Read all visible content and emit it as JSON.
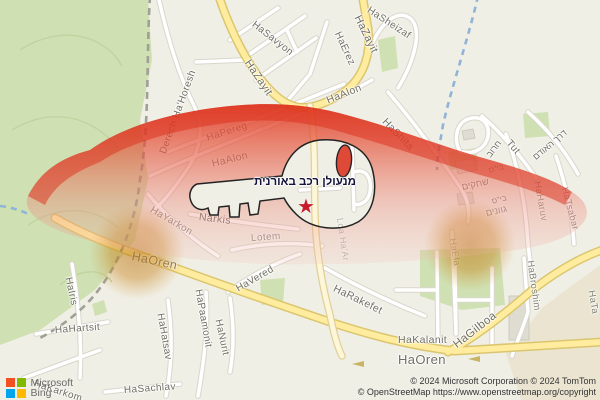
{
  "map": {
    "business": {
      "label": "מנעולן רכב באורנית",
      "marker_icon": "star-icon"
    },
    "street_labels": [
      {
        "id": "hasavyon",
        "text": "HaSavyon",
        "x": 253,
        "y": 18,
        "rot": 38,
        "size": 10
      },
      {
        "id": "hazayit-1",
        "text": "HaZayit",
        "x": 247,
        "y": 55,
        "rot": 56,
        "size": 11
      },
      {
        "id": "hazayit-2",
        "text": "HaZayit",
        "x": 357,
        "y": 10,
        "rot": 64,
        "size": 11
      },
      {
        "id": "hasheizaf",
        "text": "HaSheizaf",
        "x": 368,
        "y": 4,
        "rot": 33,
        "size": 10
      },
      {
        "id": "derech-hahoresh",
        "text": "Derech Ha'Horesh",
        "x": 163,
        "y": 148,
        "rot": -70,
        "size": 10
      },
      {
        "id": "haerez",
        "text": "HaErez",
        "x": 337,
        "y": 27,
        "rot": 65,
        "size": 10
      },
      {
        "id": "haalon-1",
        "text": "HaAlon",
        "x": 327,
        "y": 95,
        "rot": -22,
        "size": 10.5
      },
      {
        "id": "haalon-2",
        "text": "HaAlon",
        "x": 212,
        "y": 158,
        "rot": -14,
        "size": 10.5,
        "opacity": 0.85
      },
      {
        "id": "hapereg",
        "text": "HaPereg",
        "x": 207,
        "y": 133,
        "rot": -18,
        "size": 10,
        "opacity": 0.85
      },
      {
        "id": "hashita",
        "text": "HaShita",
        "x": 384,
        "y": 114,
        "rot": 46,
        "size": 10.5
      },
      {
        "id": "tut",
        "text": "Tut",
        "x": 508,
        "y": 136,
        "rot": 50,
        "size": 10
      },
      {
        "id": "derech-haodem",
        "text": "דרך האודם",
        "x": 534,
        "y": 153,
        "rot": -40,
        "size": 9,
        "hebrew": true
      },
      {
        "id": "haruv-he",
        "text": "חרוב",
        "x": 488,
        "y": 151,
        "rot": -52,
        "size": 9,
        "hebrew": true
      },
      {
        "id": "school-1",
        "text": "בי\"ס",
        "x": 489,
        "y": 166,
        "rot": -15,
        "size": 8,
        "hebrew": true,
        "opacity": 0.85
      },
      {
        "id": "shehakim",
        "text": "שחקים",
        "x": 462,
        "y": 182,
        "rot": -12,
        "size": 9.5,
        "hebrew": true,
        "opacity": 0.8
      },
      {
        "id": "school-2",
        "text": "בי\"ס",
        "x": 492,
        "y": 197,
        "rot": -15,
        "size": 8,
        "hebrew": true,
        "opacity": 0.85
      },
      {
        "id": "gvanim",
        "text": "גוונים",
        "x": 486,
        "y": 208,
        "rot": -12,
        "size": 9.5,
        "hebrew": true,
        "opacity": 0.8
      },
      {
        "id": "haharuv",
        "text": "HaHaruv",
        "x": 537,
        "y": 176,
        "rot": 80,
        "size": 9.5,
        "opacity": 0.75
      },
      {
        "id": "hatsabar",
        "text": "HaTsabar",
        "x": 564,
        "y": 182,
        "rot": 75,
        "size": 9.5,
        "opacity": 0.8
      },
      {
        "id": "hayarkon",
        "text": "HaYarkon",
        "x": 151,
        "y": 204,
        "rot": 30,
        "size": 10,
        "opacity": 0.8
      },
      {
        "id": "narkis",
        "text": "Narkis",
        "x": 199,
        "y": 211,
        "rot": 7,
        "size": 10.5
      },
      {
        "id": "lotem",
        "text": "Lotem",
        "x": 251,
        "y": 233,
        "rot": -4,
        "size": 10,
        "opacity": 0.75
      },
      {
        "id": "loa-haar",
        "text": "Loa Ha'Ar",
        "x": 340,
        "y": 213,
        "rot": 82,
        "size": 9,
        "opacity": 0.45
      },
      {
        "id": "hairis",
        "text": "HaIris",
        "x": 68,
        "y": 272,
        "rot": 78,
        "size": 10
      },
      {
        "id": "haoren-1",
        "text": "HaOren",
        "x": 132,
        "y": 249,
        "rot": 12,
        "size": 12.5,
        "opacity": 0.9
      },
      {
        "id": "havered",
        "text": "HaVered",
        "x": 237,
        "y": 284,
        "rot": -30,
        "size": 10
      },
      {
        "id": "hahatsav",
        "text": "HaHatsav",
        "x": 160,
        "y": 308,
        "rot": 80,
        "size": 10
      },
      {
        "id": "hapaamonit",
        "text": "HaPaamonit",
        "x": 198,
        "y": 284,
        "rot": 80,
        "size": 10
      },
      {
        "id": "hanurit",
        "text": "HaNurit",
        "x": 218,
        "y": 314,
        "rot": 78,
        "size": 10
      },
      {
        "id": "hahartsit",
        "text": "HaHartsit",
        "x": 55,
        "y": 325,
        "rot": -4,
        "size": 10
      },
      {
        "id": "hakarkom",
        "text": "HaKarkom",
        "x": 34,
        "y": 378,
        "rot": 18,
        "size": 10
      },
      {
        "id": "hasachlav",
        "text": "HaSachlav",
        "x": 124,
        "y": 385,
        "rot": -4,
        "size": 10
      },
      {
        "id": "harakefet",
        "text": "HaRakefet",
        "x": 334,
        "y": 282,
        "rot": 26,
        "size": 10.5
      },
      {
        "id": "hakalanit",
        "text": "HaKalanit",
        "x": 398,
        "y": 334,
        "rot": 0,
        "size": 10.5
      },
      {
        "id": "haela",
        "text": "HaEla",
        "x": 452,
        "y": 233,
        "rot": 80,
        "size": 9.5,
        "opacity": 0.55
      },
      {
        "id": "habroshim",
        "text": "HaBroshim",
        "x": 530,
        "y": 255,
        "rot": 82,
        "size": 9.5,
        "opacity": 0.85
      },
      {
        "id": "hata",
        "text": "HaTa",
        "x": 591,
        "y": 285,
        "rot": 80,
        "size": 9.5,
        "opacity": 0.85
      },
      {
        "id": "hagilboa",
        "text": "HaGilboa",
        "x": 455,
        "y": 340,
        "rot": -38,
        "size": 11.5
      },
      {
        "id": "haoren-2",
        "text": "HaOren",
        "x": 398,
        "y": 352,
        "rot": 0,
        "size": 13
      }
    ],
    "attribution": {
      "line1": "© 2024 Microsoft Corporation © 2024 TomTom",
      "line2": "© OpenStreetMap https://www.openstreetmap.org/copyright"
    },
    "logo": {
      "company": "Microsoft",
      "product": "Bing",
      "square_colors": [
        "#f25022",
        "#7fba00",
        "#00a4ef",
        "#ffb900"
      ]
    },
    "colors": {
      "overlay_red": "#e23a24",
      "circle_orange": "#c07f1a",
      "road_yellow": "#ffec9e",
      "park_green": "#cfe0b2",
      "background": "#f0efe6"
    }
  }
}
